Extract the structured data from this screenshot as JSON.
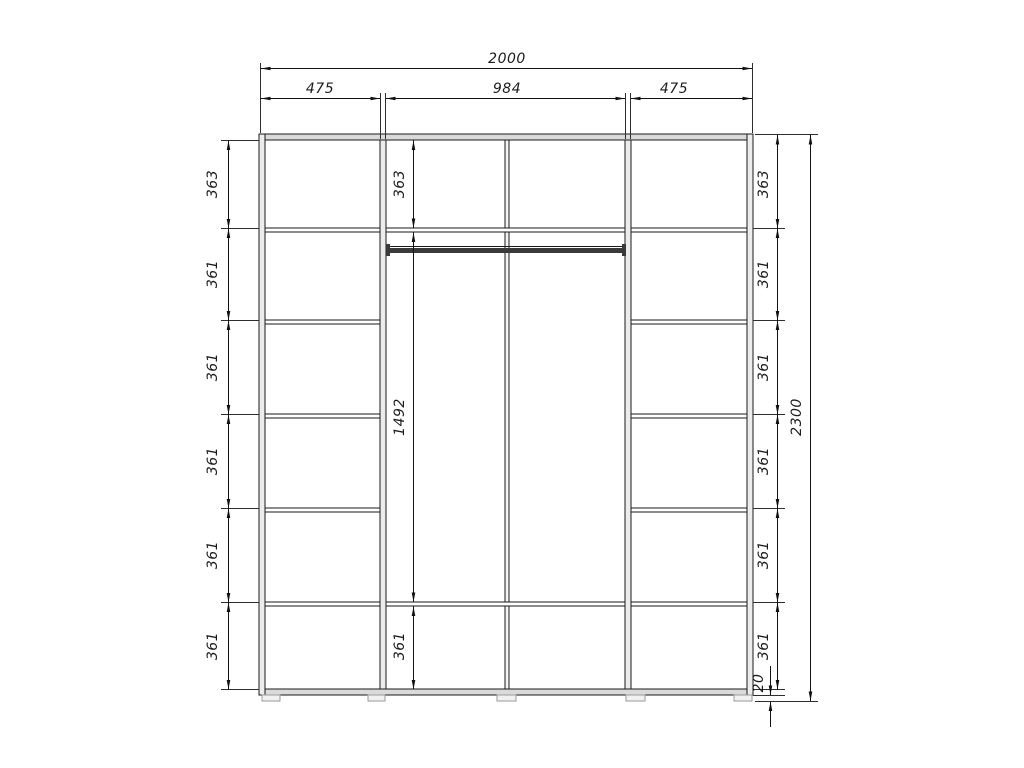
{
  "drawing": {
    "width_dims": {
      "total": "2000",
      "left": "475",
      "center": "984",
      "right": "475"
    },
    "height_dims": {
      "total": "2300",
      "feet": "20"
    },
    "left_chain": [
      "363",
      "361",
      "361",
      "361",
      "361",
      "361"
    ],
    "center_chain": [
      "363",
      "1492",
      "361"
    ],
    "right_chain": [
      "363",
      "361",
      "361",
      "361",
      "361",
      "361"
    ]
  }
}
